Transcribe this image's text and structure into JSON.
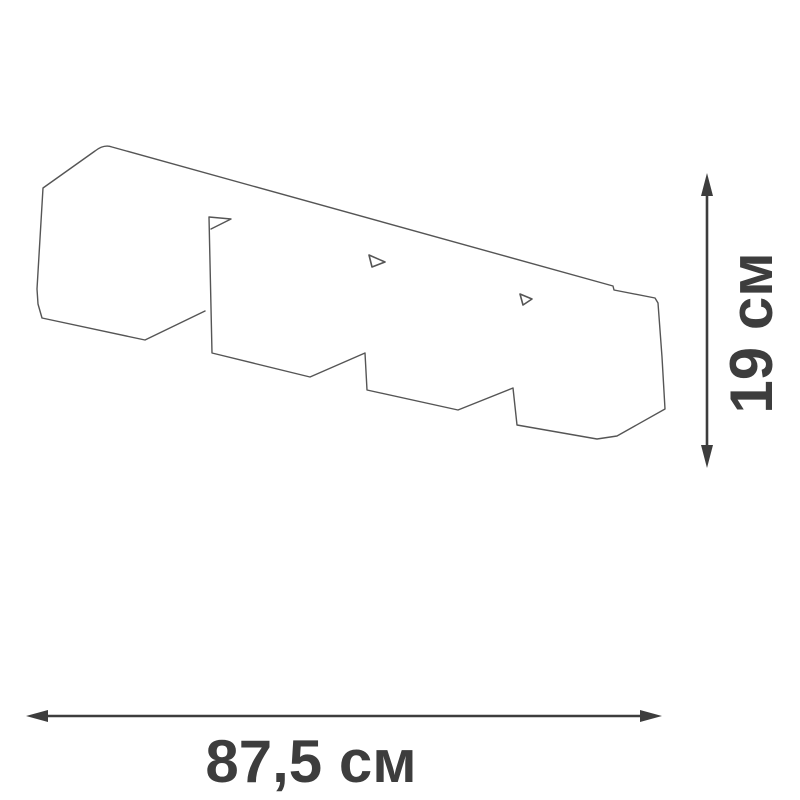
{
  "diagram": {
    "kind": "product-dimension-drawing",
    "dimensions": {
      "width": {
        "label": "87,5 см",
        "value": "87,5",
        "unit": "см"
      },
      "height": {
        "label": "19 см",
        "value": "19",
        "unit": "см"
      }
    }
  },
  "colors": {
    "background": "#ffffff",
    "outline": "#555555",
    "dimension": "#3d3d3d"
  }
}
